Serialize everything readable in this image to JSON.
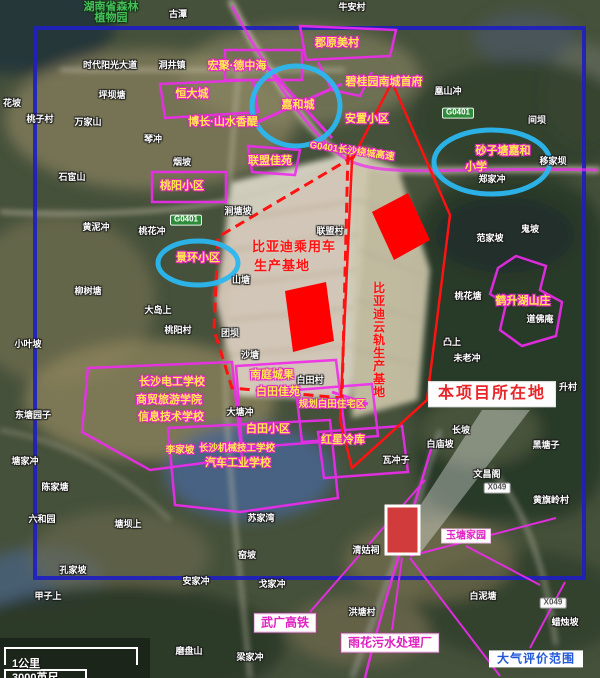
{
  "figure_title": "项目区域卫星影像图",
  "colors": {
    "annotation_magenta": "#e627c8",
    "highlight_blue_circle": "#2bb7ef",
    "assessment_border_blue": "#2020c0",
    "project_red": "#ff1212",
    "poi_text_yellow": "#ffe94d"
  },
  "scalebar": {
    "km_label": "1公里",
    "ft_label": "3000英尺"
  },
  "map": {
    "labels": [
      {
        "name": "label-forest-park-1",
        "text": "湖南省森林",
        "x": 111,
        "y": 7,
        "style": "green"
      },
      {
        "name": "label-forest-park-2",
        "text": "植物园",
        "x": 111,
        "y": 18,
        "style": "green"
      },
      {
        "name": "place-label",
        "text": "古潭",
        "x": 178,
        "y": 15,
        "style": "place"
      },
      {
        "name": "place-label",
        "text": "牛安村",
        "x": 352,
        "y": 8,
        "style": "place"
      },
      {
        "name": "place-label",
        "text": "时代阳光大道",
        "x": 110,
        "y": 66,
        "style": "place"
      },
      {
        "name": "place-label",
        "text": "洞井镇",
        "x": 172,
        "y": 66,
        "style": "place"
      },
      {
        "name": "place-label",
        "text": "凰山冲",
        "x": 448,
        "y": 92,
        "style": "place"
      },
      {
        "name": "place-label",
        "text": "花坡",
        "x": 12,
        "y": 104,
        "style": "place"
      },
      {
        "name": "place-label",
        "text": "桃子村",
        "x": 40,
        "y": 120,
        "style": "place"
      },
      {
        "name": "place-label",
        "text": "万家山",
        "x": 88,
        "y": 123,
        "style": "place"
      },
      {
        "name": "place-label",
        "text": "坪坝塘",
        "x": 112,
        "y": 96,
        "style": "place"
      },
      {
        "name": "place-label",
        "text": "琴冲",
        "x": 153,
        "y": 140,
        "style": "place"
      },
      {
        "name": "place-label",
        "text": "烟坡",
        "x": 182,
        "y": 163,
        "style": "place"
      },
      {
        "name": "place-label",
        "text": "石宦山",
        "x": 72,
        "y": 178,
        "style": "place"
      },
      {
        "name": "place-label",
        "text": "间坝",
        "x": 537,
        "y": 121,
        "style": "place"
      },
      {
        "name": "place-label",
        "text": "移家坝",
        "x": 553,
        "y": 162,
        "style": "place"
      },
      {
        "name": "place-label",
        "text": "郑家冲",
        "x": 492,
        "y": 180,
        "style": "place"
      },
      {
        "name": "place-label",
        "text": "黄泥冲",
        "x": 96,
        "y": 228,
        "style": "place"
      },
      {
        "name": "place-label",
        "text": "桃花冲",
        "x": 152,
        "y": 232,
        "style": "place"
      },
      {
        "name": "place-label",
        "text": "涧塘坡",
        "x": 238,
        "y": 212,
        "style": "place"
      },
      {
        "name": "place-label",
        "text": "柳树塘",
        "x": 88,
        "y": 292,
        "style": "place"
      },
      {
        "name": "place-label",
        "text": "大岛上",
        "x": 158,
        "y": 311,
        "style": "place"
      },
      {
        "name": "place-label",
        "text": "小叶坡",
        "x": 28,
        "y": 345,
        "style": "place"
      },
      {
        "name": "place-label",
        "text": "桃阳村",
        "x": 178,
        "y": 331,
        "style": "place"
      },
      {
        "name": "place-label",
        "text": "团坝",
        "x": 230,
        "y": 334,
        "style": "place"
      },
      {
        "name": "place-label",
        "text": "山塘",
        "x": 241,
        "y": 281,
        "style": "place"
      },
      {
        "name": "place-label",
        "text": "沙塘",
        "x": 250,
        "y": 356,
        "style": "place"
      },
      {
        "name": "place-label",
        "text": "联盟村",
        "x": 330,
        "y": 232,
        "style": "place"
      },
      {
        "name": "place-label",
        "text": "范家坡",
        "x": 490,
        "y": 239,
        "style": "place"
      },
      {
        "name": "place-label",
        "text": "鬼坡",
        "x": 530,
        "y": 230,
        "style": "place"
      },
      {
        "name": "place-label",
        "text": "桃花塘",
        "x": 468,
        "y": 297,
        "style": "place"
      },
      {
        "name": "place-label",
        "text": "道佛庵",
        "x": 540,
        "y": 320,
        "style": "place"
      },
      {
        "name": "place-label",
        "text": "凸上",
        "x": 452,
        "y": 343,
        "style": "place"
      },
      {
        "name": "place-label",
        "text": "未老冲",
        "x": 467,
        "y": 359,
        "style": "place"
      },
      {
        "name": "place-label",
        "text": "升村",
        "x": 568,
        "y": 388,
        "style": "place"
      },
      {
        "name": "place-label",
        "text": "白田村",
        "x": 310,
        "y": 381,
        "style": "place"
      },
      {
        "name": "place-label",
        "text": "大塘冲",
        "x": 240,
        "y": 413,
        "style": "place"
      },
      {
        "name": "place-label",
        "text": "瓦冲子",
        "x": 396,
        "y": 461,
        "style": "place"
      },
      {
        "name": "place-label",
        "text": "东塘园子",
        "x": 33,
        "y": 416,
        "style": "place"
      },
      {
        "name": "place-label",
        "text": "塘家冲",
        "x": 25,
        "y": 462,
        "style": "place"
      },
      {
        "name": "place-label",
        "text": "陈家塘",
        "x": 55,
        "y": 488,
        "style": "place"
      },
      {
        "name": "place-label",
        "text": "六和园",
        "x": 42,
        "y": 520,
        "style": "place"
      },
      {
        "name": "place-label",
        "text": "塘坝上",
        "x": 128,
        "y": 525,
        "style": "place"
      },
      {
        "name": "place-label",
        "text": "孔家坡",
        "x": 73,
        "y": 571,
        "style": "place"
      },
      {
        "name": "place-label",
        "text": "甲子上",
        "x": 48,
        "y": 597,
        "style": "place"
      },
      {
        "name": "place-label",
        "text": "长坡",
        "x": 461,
        "y": 431,
        "style": "place"
      },
      {
        "name": "place-label",
        "text": "白庙坡",
        "x": 440,
        "y": 445,
        "style": "place"
      },
      {
        "name": "place-label",
        "text": "黑塘子",
        "x": 546,
        "y": 446,
        "style": "place"
      },
      {
        "name": "place-label",
        "text": "文昌阁",
        "x": 487,
        "y": 475,
        "style": "place"
      },
      {
        "name": "place-label",
        "text": "黄旗岭村",
        "x": 551,
        "y": 501,
        "style": "place"
      },
      {
        "name": "place-label",
        "text": "苏家湾",
        "x": 261,
        "y": 519,
        "style": "place"
      },
      {
        "name": "place-label",
        "text": "窑坡",
        "x": 247,
        "y": 556,
        "style": "place"
      },
      {
        "name": "place-label",
        "text": "安家冲",
        "x": 196,
        "y": 582,
        "style": "place"
      },
      {
        "name": "place-label",
        "text": "戈家冲",
        "x": 272,
        "y": 585,
        "style": "place"
      },
      {
        "name": "place-label",
        "text": "清姑祠",
        "x": 366,
        "y": 551,
        "style": "place"
      },
      {
        "name": "place-label",
        "text": "洪塘村",
        "x": 362,
        "y": 613,
        "style": "place"
      },
      {
        "name": "place-label",
        "text": "白泥塘",
        "x": 483,
        "y": 597,
        "style": "place"
      },
      {
        "name": "place-label",
        "text": "蜡烛坡",
        "x": 565,
        "y": 623,
        "style": "place"
      },
      {
        "name": "place-label",
        "text": "磨盘山",
        "x": 189,
        "y": 652,
        "style": "place"
      },
      {
        "name": "place-label",
        "text": "梁家冲",
        "x": 250,
        "y": 658,
        "style": "place"
      },
      {
        "name": "poi-label",
        "text": "郡原美村",
        "x": 337,
        "y": 43,
        "style": "poi"
      },
      {
        "name": "poi-label",
        "text": "宏聚·德中海",
        "x": 237,
        "y": 66,
        "style": "poi"
      },
      {
        "name": "poi-label",
        "text": "恒大城",
        "x": 192,
        "y": 94,
        "style": "poi"
      },
      {
        "name": "poi-label-jiahecheng",
        "text": "嘉和城",
        "x": 298,
        "y": 105,
        "style": "poi"
      },
      {
        "name": "poi-label",
        "text": "碧桂园南城首府",
        "x": 384,
        "y": 82,
        "style": "poi"
      },
      {
        "name": "poi-label",
        "text": "安置小区",
        "x": 367,
        "y": 119,
        "style": "poi"
      },
      {
        "name": "poi-label",
        "text": "博长·山水香醍",
        "x": 223,
        "y": 122,
        "style": "poi"
      },
      {
        "name": "poi-label",
        "text": "联盟佳苑",
        "x": 270,
        "y": 161,
        "style": "poi"
      },
      {
        "name": "poi-label",
        "text": "桃阳小区",
        "x": 182,
        "y": 186,
        "style": "poi"
      },
      {
        "name": "poi-label-jinghuan",
        "text": "景环小区",
        "x": 198,
        "y": 258,
        "style": "poi"
      },
      {
        "name": "poi-label-school-1",
        "text": "砂子塘嘉和",
        "x": 503,
        "y": 151,
        "style": "poi"
      },
      {
        "name": "poi-label-school-2",
        "text": "小学",
        "x": 476,
        "y": 167,
        "style": "poi"
      },
      {
        "name": "poi-label",
        "text": "鹤升湖山庄",
        "x": 523,
        "y": 301,
        "style": "poi"
      },
      {
        "name": "poi-label",
        "text": "南庭城果",
        "x": 272,
        "y": 375,
        "style": "poi"
      },
      {
        "name": "poi-label",
        "text": "白田佳苑",
        "x": 278,
        "y": 392,
        "style": "poi"
      },
      {
        "name": "poi-label",
        "text": "规划白田住宅区",
        "x": 332,
        "y": 405,
        "style": "poi-sm"
      },
      {
        "name": "poi-label",
        "text": "白田小区",
        "x": 268,
        "y": 429,
        "style": "poi"
      },
      {
        "name": "poi-label",
        "text": "红星冷库",
        "x": 343,
        "y": 440,
        "style": "poi"
      },
      {
        "name": "poi-label",
        "text": "长沙电工学校",
        "x": 172,
        "y": 382,
        "style": "poi"
      },
      {
        "name": "poi-label",
        "text": "商贸旅游学院",
        "x": 169,
        "y": 400,
        "style": "poi"
      },
      {
        "name": "poi-label",
        "text": "信息技术学校",
        "x": 171,
        "y": 417,
        "style": "poi"
      },
      {
        "name": "poi-label",
        "text": "长沙机械技工学校",
        "x": 237,
        "y": 449,
        "style": "poi-sm"
      },
      {
        "name": "poi-label",
        "text": "汽车工业学校",
        "x": 238,
        "y": 463,
        "style": "poi"
      },
      {
        "name": "poi-label",
        "text": "李家坡",
        "x": 180,
        "y": 451,
        "style": "poi-sm"
      },
      {
        "name": "road-label-g0401",
        "text": "G0401长沙绕城高速",
        "x": 352,
        "y": 152,
        "style": "poi-sm",
        "rotate": 8
      },
      {
        "name": "byd-base-label-1",
        "text": "比亚迪乘用车",
        "x": 294,
        "y": 247,
        "style": "red"
      },
      {
        "name": "byd-base-label-2",
        "text": "生产基地",
        "x": 282,
        "y": 266,
        "style": "red"
      },
      {
        "name": "byd-skyrail-label",
        "text": "比亚迪云轨生产基地",
        "x": 378,
        "y": 340,
        "style": "red-v"
      },
      {
        "name": "project-site-label",
        "text": "本项目所在地",
        "x": 492,
        "y": 394,
        "style": "box-red"
      },
      {
        "name": "hsr-label",
        "text": "武广高铁",
        "x": 285,
        "y": 623,
        "style": "box-magenta"
      },
      {
        "name": "sewage-plant-label",
        "text": "雨花污水处理厂",
        "x": 390,
        "y": 643,
        "style": "box-magenta"
      },
      {
        "name": "yutang-label",
        "text": "玉塘家园",
        "x": 466,
        "y": 536,
        "style": "box-magenta-sm"
      },
      {
        "name": "air-assessment-scope-label",
        "text": "大气评价范围",
        "x": 536,
        "y": 659,
        "style": "box-blue"
      },
      {
        "name": "road-badge-g0401",
        "text": "G0401",
        "x": 458,
        "y": 113,
        "style": "badge-green"
      },
      {
        "name": "road-badge-g0401",
        "text": "G0401",
        "x": 186,
        "y": 220,
        "style": "badge-green"
      },
      {
        "name": "road-badge-x049",
        "text": "X049",
        "x": 497,
        "y": 488,
        "style": "badge-white"
      },
      {
        "name": "road-badge-x049",
        "text": "X049",
        "x": 553,
        "y": 603,
        "style": "badge-white"
      }
    ]
  }
}
